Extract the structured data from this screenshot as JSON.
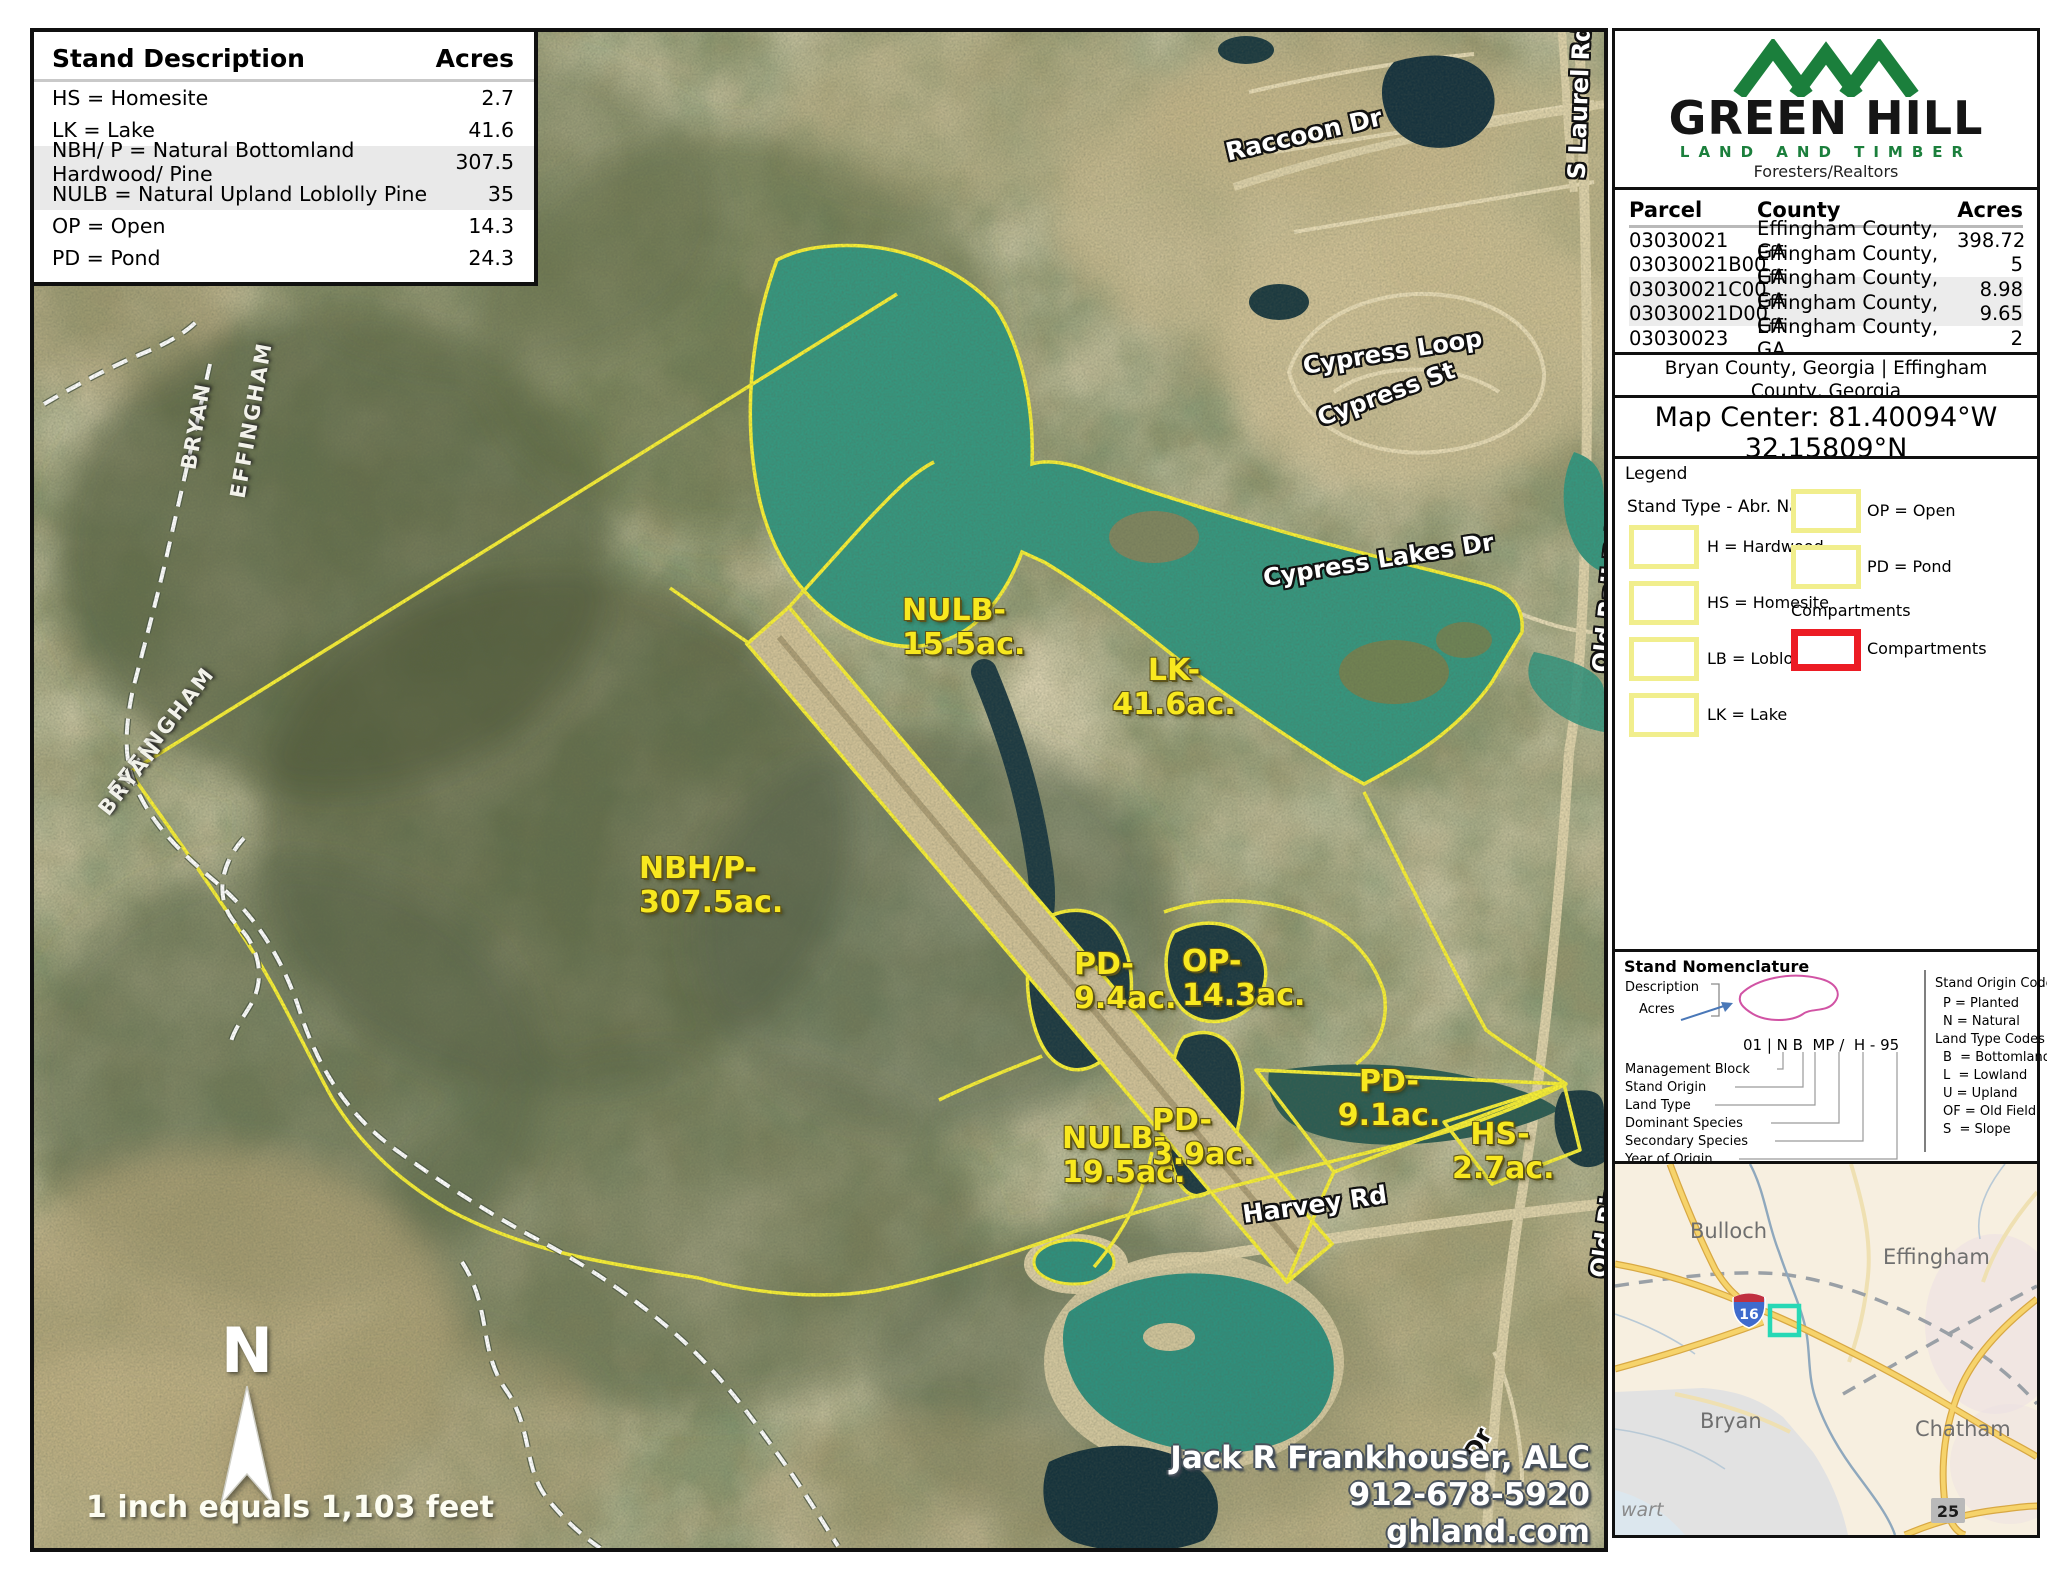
{
  "stand_table": {
    "title": "Stand Description",
    "acres_header": "Acres",
    "rows": [
      {
        "label": "HS = Homesite",
        "acres": "2.7"
      },
      {
        "label": "LK = Lake",
        "acres": "41.6"
      },
      {
        "label": "NBH/ P = Natural Bottomland Hardwood/ Pine",
        "acres": "307.5"
      },
      {
        "label": "NULB = Natural Upland Loblolly Pine",
        "acres": "35"
      },
      {
        "label": "OP = Open",
        "acres": "14.3"
      },
      {
        "label": "PD = Pond",
        "acres": "24.3"
      }
    ]
  },
  "map": {
    "stand_labels": [
      {
        "l1": "NULB-",
        "l2": "15.5ac."
      },
      {
        "l1": "LK-",
        "l2": "41.6ac."
      },
      {
        "l1": "NBH/P-",
        "l2": "307.5ac."
      },
      {
        "l1": "PD-",
        "l2": "9.4ac."
      },
      {
        "l1": "OP-",
        "l2": "14.3ac."
      },
      {
        "l1": "PD-",
        "l2": "9.1ac."
      },
      {
        "l1": "NULB-",
        "l2": "19.5ac."
      },
      {
        "l1": "PD-",
        "l2": "3.9ac."
      },
      {
        "l1": "HS-",
        "l2": "2.7ac."
      }
    ],
    "road_labels": [
      {
        "text": "Raccoon Dr"
      },
      {
        "text": "Cypress Loop"
      },
      {
        "text": "Cypress St"
      },
      {
        "text": "Cypress Lakes Dr"
      },
      {
        "text": "S Laurel Rd"
      },
      {
        "text": "Old Rail Rd"
      },
      {
        "text": "Old River Rd"
      },
      {
        "text": "Harvey Rd"
      },
      {
        "text": "Dr"
      }
    ],
    "county_labels": [
      {
        "text": "BRYAN"
      },
      {
        "text": "EFFINGHAM"
      },
      {
        "text": "EFFINGHAM"
      },
      {
        "text": "BRYAN"
      }
    ],
    "north_label": "N",
    "scale_text": "1 inch equals 1,103 feet",
    "contact": {
      "name": "Jack R Frankhouser, ALC",
      "phone": "912-678-5920",
      "website": "ghland.com"
    }
  },
  "sidebar": {
    "logo": {
      "brand": "GREEN HILL",
      "land_timber": "LAND AND TIMBER",
      "tagline": "Foresters/Realtors"
    },
    "parcels": {
      "headers": {
        "parcel": "Parcel",
        "county": "County",
        "acres": "Acres"
      },
      "rows": [
        {
          "parcel": "03030021",
          "county": "Effingham County, GA",
          "acres": "398.72"
        },
        {
          "parcel": "03030021B00",
          "county": "Effingham County, GA",
          "acres": "5"
        },
        {
          "parcel": "03030021C00",
          "county": "Effingham County, GA",
          "acres": "8.98"
        },
        {
          "parcel": "03030021D00",
          "county": "Effingham County, GA",
          "acres": "9.65"
        },
        {
          "parcel": "03030023",
          "county": "Effingham County, GA",
          "acres": "2"
        }
      ]
    },
    "counties": {
      "line1": "Bryan County, Georgia |  Effingham",
      "line2": "County, Georgia"
    },
    "map_center": {
      "line1": "Map Center: 81.40094°W",
      "line2": "32.15809°N"
    },
    "legend": {
      "title": "Legend",
      "subtitle": "Stand Type - Abr. Name",
      "left_items": [
        "H = Hardwood",
        "HS = Homesite",
        "LB = Loblolly Pine",
        "LK = Lake"
      ],
      "right_items": [
        "OP = Open",
        "PD = Pond"
      ],
      "compartments_heading": "Compartments",
      "compartments_item": "Compartments"
    },
    "nomenclature": {
      "title": "Stand Nomenclature",
      "description_label": "Description",
      "acres_label": "Acres",
      "code": "01 | N B  MP /  H - 95",
      "left_labels": [
        "Management Block",
        "Stand Origin",
        "Land Type",
        "Dominant Species",
        "Secondary Species",
        "Year of Origin"
      ],
      "origin_title": "Stand Origin Codes",
      "origin_codes": [
        "P = Planted",
        "N = Natural"
      ],
      "land_title": "Land Type Codes",
      "land_codes": [
        "B  = Bottomland",
        "L  = Lowland",
        "U = Upland",
        "OF = Old Field",
        "S  = Slope"
      ],
      "interstate_note": ""
    },
    "inset": {
      "counties": [
        "Bulloch",
        "Effingham",
        "Bryan",
        "Chatham"
      ],
      "partial_label": "wart",
      "interstate_shield": "16",
      "route_badge": "25"
    }
  },
  "colors": {
    "boundary_yellow": "#f8ef35",
    "label_yellow": "#f8e81f",
    "lake_teal": "#36967e",
    "pond_dark": "#1c3a40",
    "compartment_red": "#ec1c24",
    "brand_green": "#1b7f3c"
  }
}
